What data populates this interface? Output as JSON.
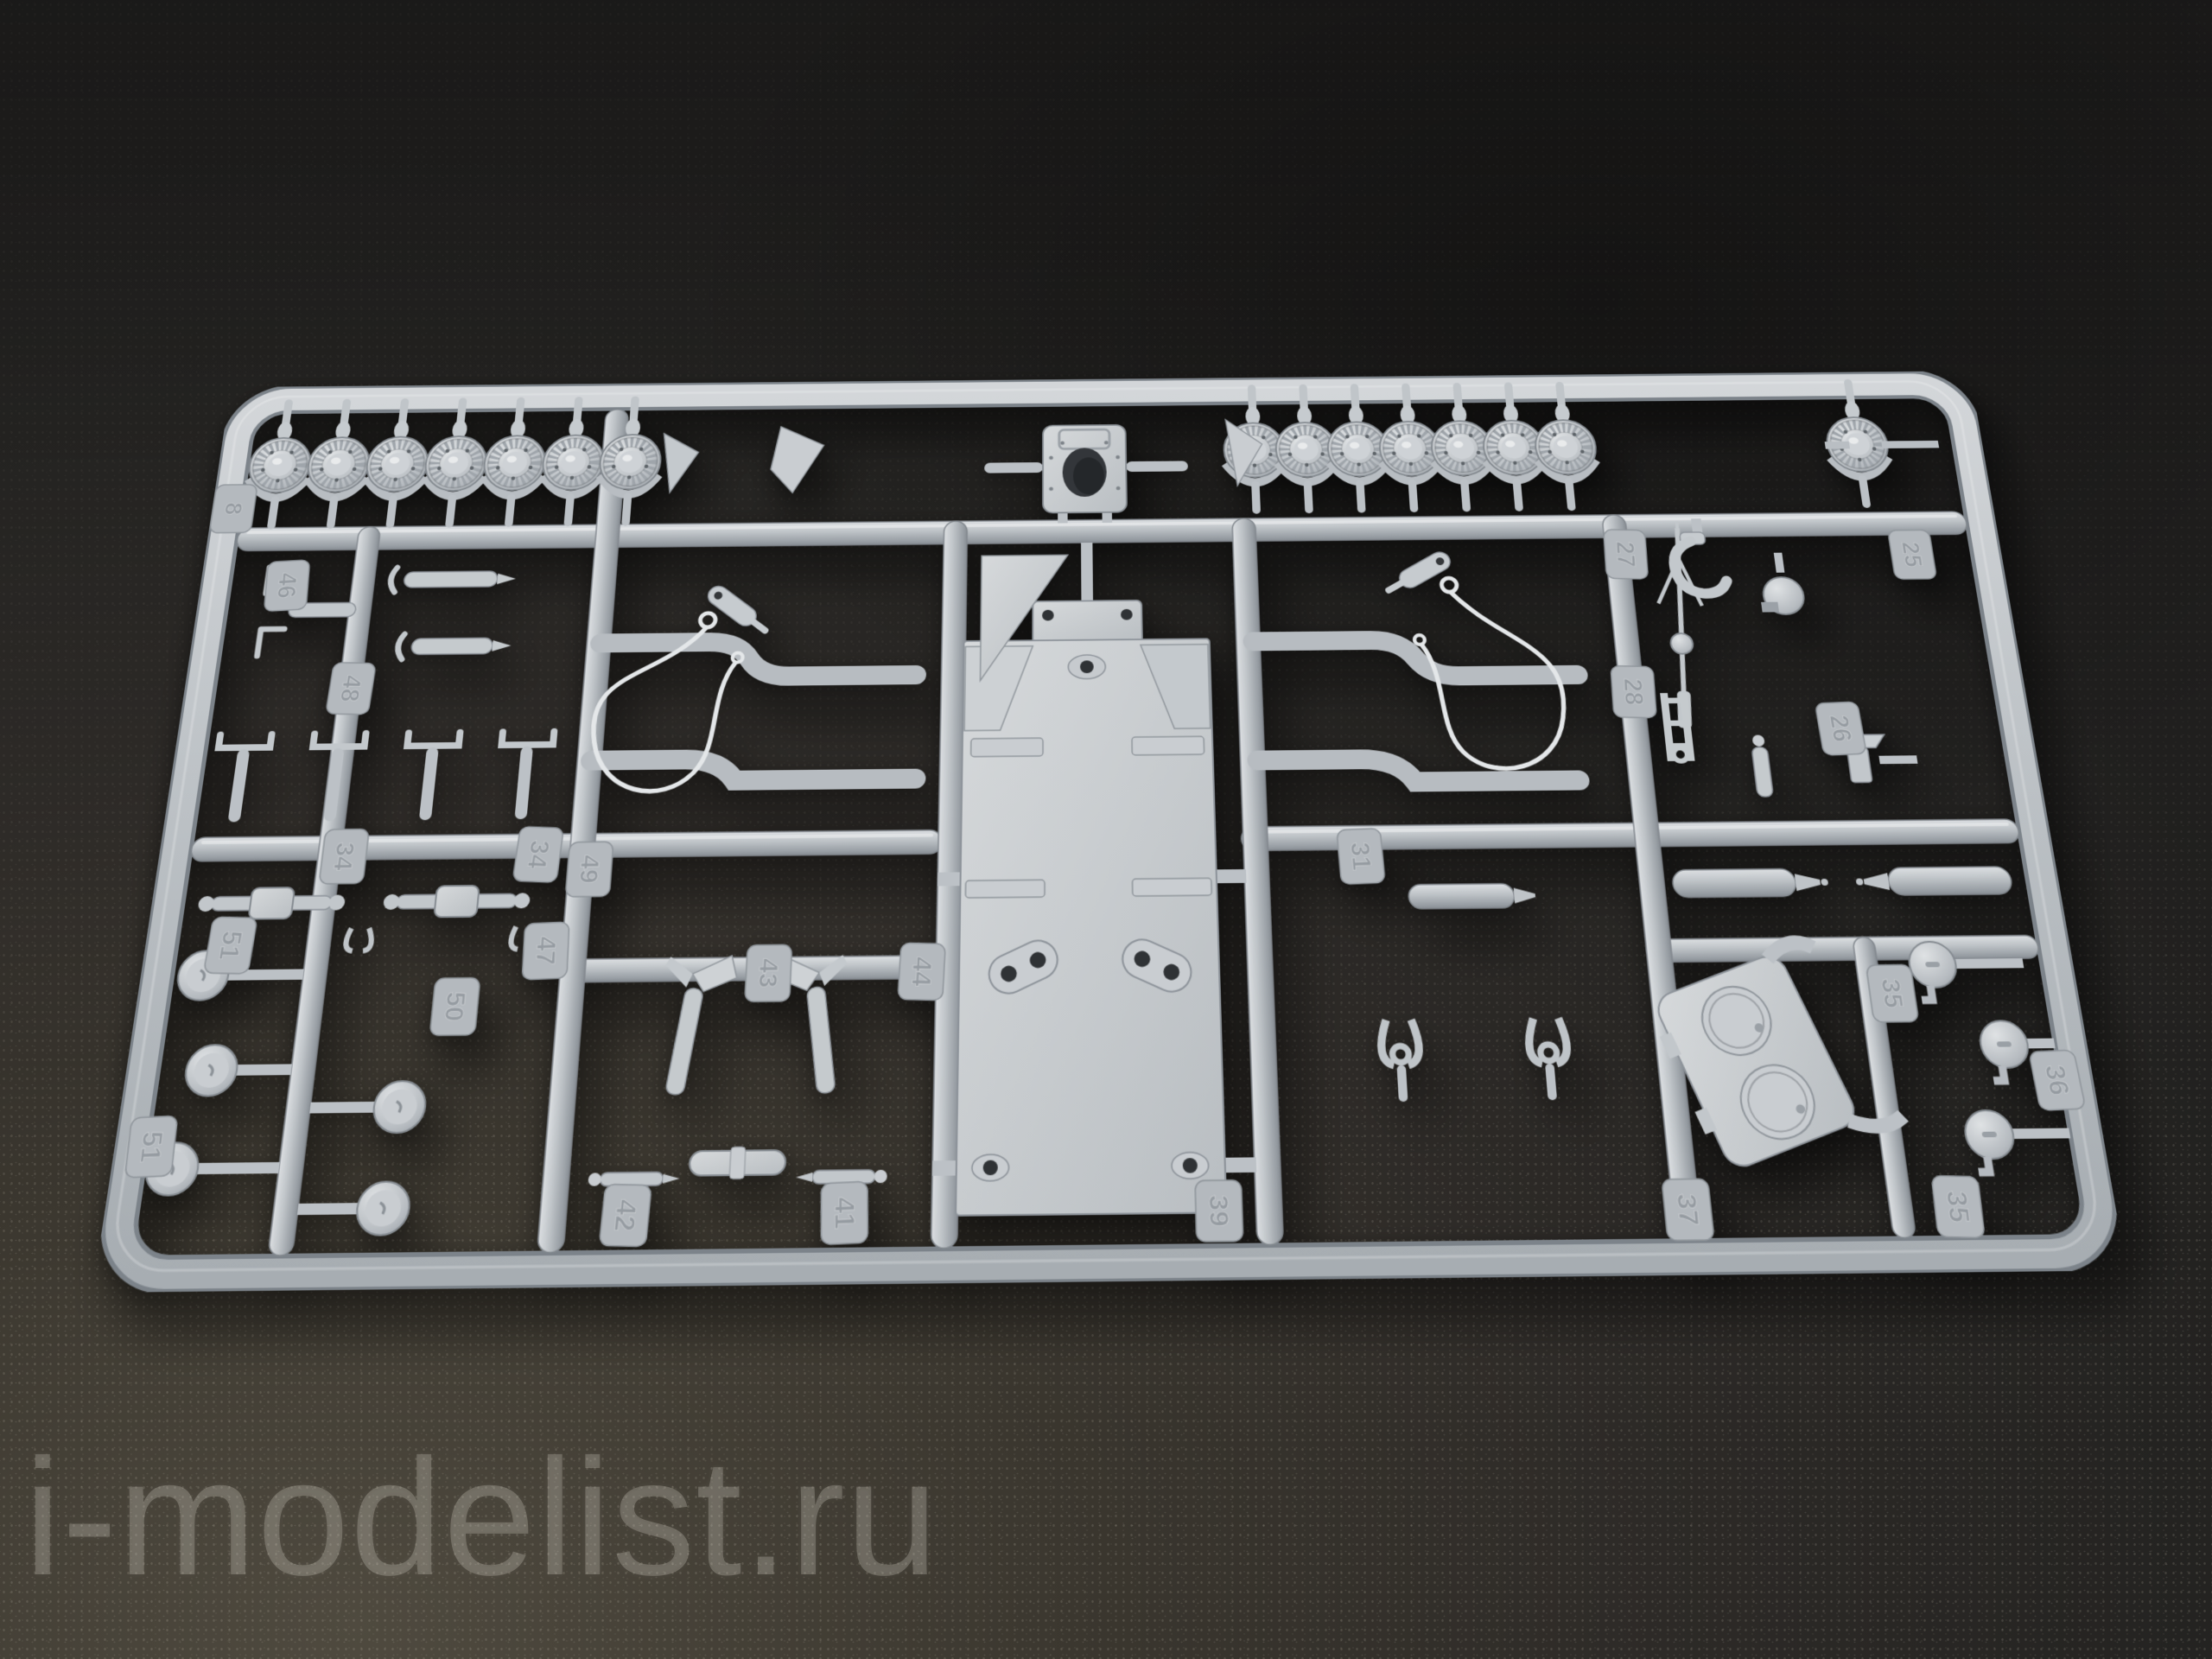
{
  "photo": {
    "subject": "Light-gray injection-molded plastic model kit sprue photographed on a dark textured carpet",
    "watermark": {
      "text": "i-modelist.ru"
    },
    "brand_tab": {
      "name": "ZVEZDA",
      "year": "2014",
      "logo": "star-with-speed-lines"
    },
    "colors": {
      "plastic_light": "#dfe2e4",
      "plastic_mid": "#b9bec3",
      "plastic_dark": "#878d93",
      "background_dark": "#242321",
      "background_light": "#4f4a3f",
      "watermark": "rgba(216,211,199,0.26)"
    },
    "part_tags": [
      "8",
      "46",
      "48",
      "34",
      "34",
      "49",
      "47",
      "51",
      "50",
      "51",
      "42",
      "41",
      "43",
      "44",
      "39",
      "31",
      "27",
      "25",
      "26",
      "28",
      "35",
      "36",
      "35",
      "37"
    ],
    "parts_inventory": [
      {
        "part": "spoked road wheel",
        "count": 15
      },
      {
        "part": "gearbox / final-drive housing",
        "count": 1
      },
      {
        "part": "hull floor plate with side wings",
        "count": 1
      },
      {
        "part": "tow cable with eyelets",
        "count": 2
      },
      {
        "part": "towing shackle handle",
        "count": 4
      },
      {
        "part": "bracket axle",
        "count": 4
      },
      {
        "part": "roller axle (dumbbell)",
        "count": 2
      },
      {
        "part": "hub cap drum",
        "count": 5
      },
      {
        "part": "pioneer axe",
        "count": 2
      },
      {
        "part": "fork bracket",
        "count": 2
      },
      {
        "part": "muffler cylinder",
        "count": 3
      },
      {
        "part": "twin round-hatch panel",
        "count": 1
      },
      {
        "part": "hatch cap wheel",
        "count": 3
      },
      {
        "part": "machine gun",
        "count": 1
      },
      {
        "part": "tow hook",
        "count": 1
      },
      {
        "part": "dome ball mount",
        "count": 1
      },
      {
        "part": "periscope block",
        "count": 1
      },
      {
        "part": "ladder bracket",
        "count": 1
      }
    ]
  }
}
